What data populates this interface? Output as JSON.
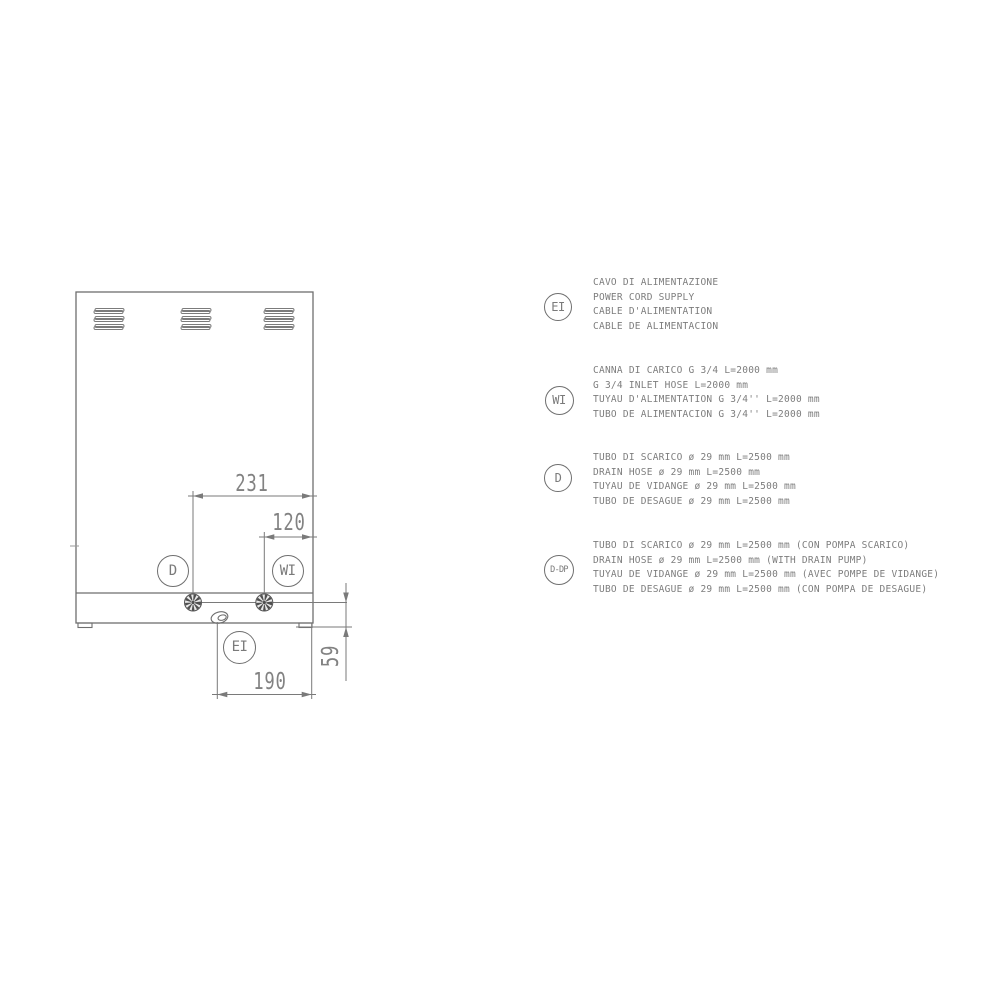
{
  "drawing": {
    "dimensions": {
      "top_width": "231",
      "inner_width": "120",
      "bottom_width": "190",
      "right_height": "59"
    },
    "callouts": {
      "drain": "D",
      "water_inlet": "WI",
      "electric_inlet": "EI"
    }
  },
  "legend": {
    "items": [
      {
        "symbol": "EI",
        "lines": [
          "CAVO DI ALIMENTAZIONE",
          "POWER CORD SUPPLY",
          "CABLE D'ALIMENTATION",
          "CABLE DE ALIMENTACION"
        ]
      },
      {
        "symbol": "WI",
        "lines": [
          "CANNA DI CARICO G 3/4 L=2000 mm",
          "G 3/4 INLET HOSE L=2000 mm",
          "TUYAU D'ALIMENTATION G 3/4'' L=2000 mm",
          "TUBO DE ALIMENTACION G 3/4'' L=2000 mm"
        ]
      },
      {
        "symbol": "D",
        "lines": [
          "TUBO DI SCARICO ø 29 mm L=2500 mm",
          "DRAIN HOSE ø 29 mm L=2500 mm",
          "TUYAU DE VIDANGE ø 29 mm L=2500 mm",
          "TUBO DE DESAGUE ø 29 mm L=2500 mm"
        ]
      },
      {
        "symbol": "D-DP",
        "lines": [
          "TUBO DI SCARICO ø 29 mm L=2500 mm (CON POMPA SCARICO)",
          "DRAIN HOSE ø 29 mm L=2500 mm (WITH DRAIN PUMP)",
          "TUYAU DE VIDANGE ø 29 mm L=2500 mm (AVEC POMPE DE VIDANGE)",
          "TUBO DE DESAGUE ø 29 mm L=2500 mm (CON POMPA DE DESAGUE)"
        ]
      }
    ]
  },
  "colors": {
    "background": "#ffffff",
    "drawing_line": "#6e6e6e",
    "dimension_line": "#7a7a7a",
    "text": "#7d7d7d",
    "dimension_text": "#828282",
    "connector_dark": "#4f4f4f"
  }
}
